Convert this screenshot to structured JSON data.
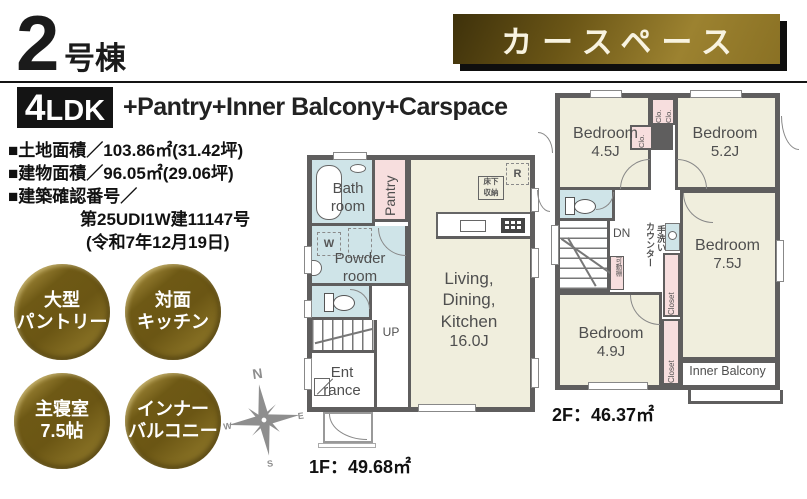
{
  "header": {
    "unit_number": "2",
    "unit_suffix": "号棟",
    "banner": "カースペース",
    "layout_main": "4",
    "layout_sub": "LDK",
    "layout_extras": "+Pantry+Inner Balcony+Carspace"
  },
  "specs": {
    "land_area": "■土地面積／103.86㎡(31.42坪)",
    "building_area": "■建物面積／96.05㎡(29.06坪)",
    "confirmation_label": "■建築確認番号／",
    "confirmation_number": "第25UDI1W建11147号",
    "confirmation_date": "(令和7年12月19日)"
  },
  "features": [
    {
      "id": "large-pantry",
      "line1": "大型",
      "line2": "パントリー"
    },
    {
      "id": "open-kitchen",
      "line1": "対面",
      "line2": "キッチン"
    },
    {
      "id": "master-bedroom",
      "line1": "主寝室",
      "line2": "7.5帖"
    },
    {
      "id": "inner-balcony",
      "line1": "インナー",
      "line2": "バルコニー"
    }
  ],
  "compass": {
    "n": "N",
    "e": "E",
    "s": "S",
    "w": "W"
  },
  "floor1": {
    "area": "1F：49.68㎡",
    "rooms": {
      "bath_l1": "Bath",
      "bath_l2": "room",
      "pantry": "Pantry",
      "powder_l1": "Powder",
      "powder_l2": "room",
      "ldk_l1": "Living,",
      "ldk_l2": "Dining,",
      "ldk_l3": "Kitchen",
      "ldk_l4": "16.0J",
      "entrance_l1": "Ent",
      "entrance_l2": "rance"
    },
    "labels": {
      "up": "UP",
      "floor_storage_l1": "床下",
      "floor_storage_l2": "収納",
      "fridge": "R",
      "washer": "W"
    }
  },
  "floor2": {
    "area": "2F：46.37㎡",
    "rooms": {
      "bedroom1_name": "Bedroom",
      "bedroom1_size": "4.5J",
      "bedroom2_name": "Bedroom",
      "bedroom2_size": "5.2J",
      "bedroom3_name": "Bedroom",
      "bedroom3_size": "7.5J",
      "bedroom4_name": "Bedroom",
      "bedroom4_size": "4.9J",
      "inner_balcony": "Inner Balcony"
    },
    "labels": {
      "dn": "DN",
      "clo": "Clo.",
      "closet": "Closet",
      "counter": "カウンター",
      "hand_wash": "手洗い",
      "movable_shelf": "可動棚"
    }
  },
  "colors": {
    "wall": "#5f5e5e",
    "room_cream": "#f0eedd",
    "room_blue": "#cfe4e8",
    "room_pink": "#f7dede",
    "gold_dark": "#6b5614",
    "gold_light": "#9c8430",
    "banner_text": "#f8f3e0"
  }
}
